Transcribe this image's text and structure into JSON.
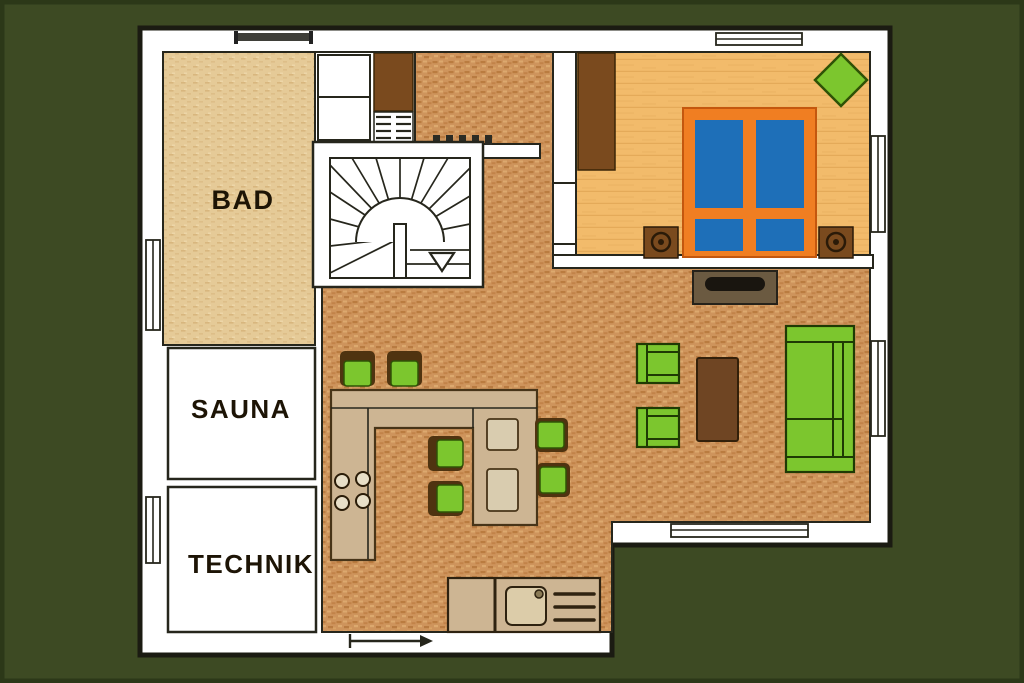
{
  "plan": {
    "type": "floor-plan",
    "rooms": [
      {
        "id": "bad",
        "label": "BAD"
      },
      {
        "id": "sauna",
        "label": "SAUNA"
      },
      {
        "id": "technik",
        "label": "TECHNIK"
      },
      {
        "id": "bedroom",
        "label": ""
      },
      {
        "id": "living-kitchen",
        "label": ""
      }
    ],
    "furniture": [
      "staircase",
      "closet",
      "shoe-shelf",
      "wardrobe",
      "double-bed",
      "nightstand-left",
      "nightstand-right",
      "plant",
      "tv-sideboard",
      "sofa",
      "armchair",
      "coffee-table",
      "kitchen-counter",
      "stove-burners",
      "dining-table",
      "bar-stool",
      "dining-chair",
      "sink-unit",
      "down-arrow"
    ],
    "openings": [
      "window-top-left",
      "window-top-bedroom",
      "window-right-bedroom",
      "window-right-living",
      "window-bottom-living",
      "window-left-upper",
      "window-left-lower",
      "door-bottom"
    ]
  },
  "palette": {
    "background": "#3D4A23",
    "wall-fill": "#FFFFFF",
    "outline": "#1B1B12",
    "innerline": "#26261c",
    "bad-floor": "#E5CA97",
    "bad-fleck": "#D8B67E",
    "brick-floor": "#CE945C",
    "brick-dark": "#BA7C40",
    "brick-light": "#DCA96E",
    "bedroom-floor": "#F2BB6B",
    "bedroom-plank": "#E3A857",
    "green": "#7CC62E",
    "green-dark": "#2E5206",
    "brown": "#7A4A1E",
    "brown-dark": "#4F3310",
    "bed-orange": "#F07E22",
    "bed-blue": "#1E6FB8",
    "counter-tan": "#CDB593",
    "placemat": "#D9CCAF",
    "tv-stand": "#6B5A41"
  }
}
